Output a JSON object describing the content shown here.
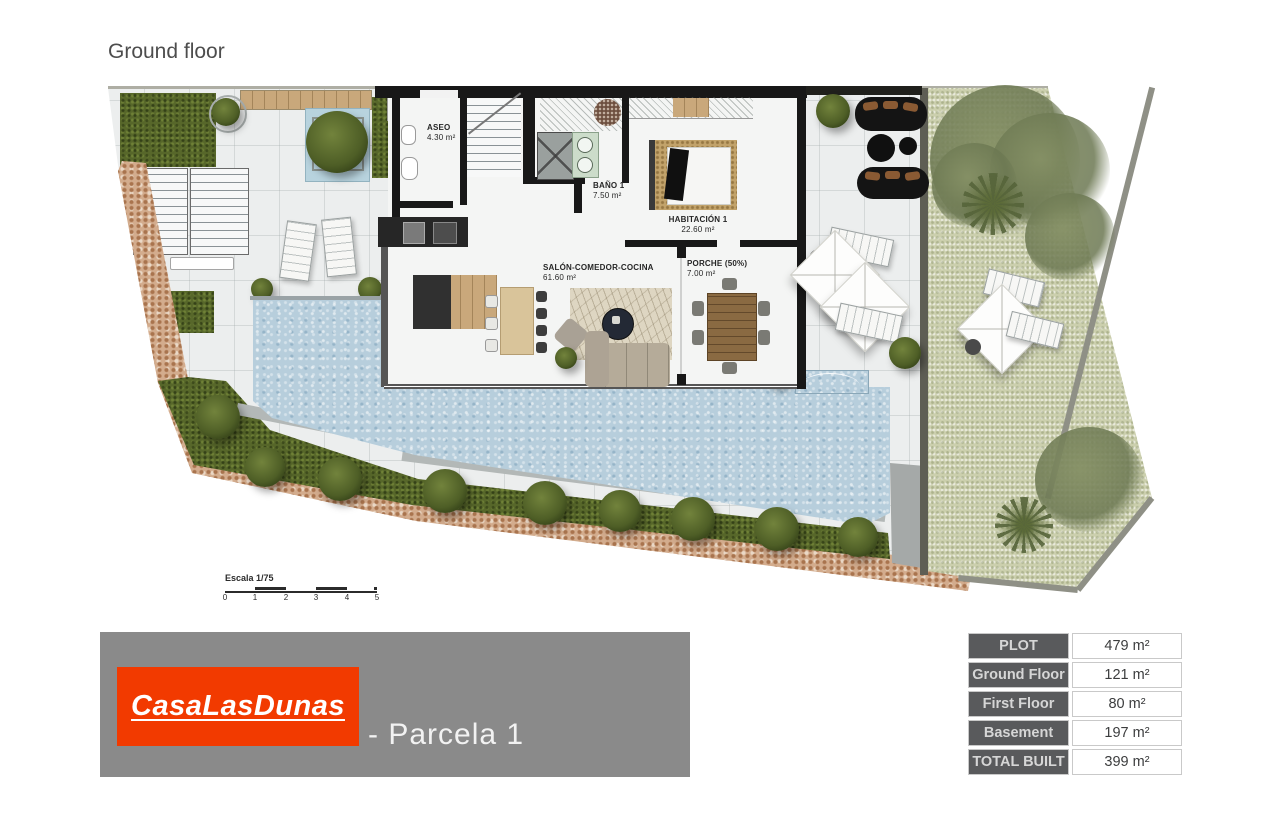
{
  "page": {
    "title": "Ground floor"
  },
  "plan": {
    "rooms": [
      {
        "name": "ASEO",
        "area": "4.30 m²"
      },
      {
        "name": "BAÑO 1",
        "area": "7.50 m²"
      },
      {
        "name": "HABITACIÓN 1",
        "area": "22.60 m²"
      },
      {
        "name": "SALÓN-COMEDOR-COCINA",
        "area": "61.60 m²"
      },
      {
        "name": "PORCHE (50%)",
        "area": "7.00 m²"
      }
    ],
    "scale": {
      "label": "Escala 1/75",
      "ticks": [
        "0",
        "1",
        "2",
        "3",
        "4",
        "5"
      ]
    }
  },
  "branding": {
    "logo_text": "CasaLasDunas",
    "parcel_label": "- Parcela 1"
  },
  "areas_table": {
    "rows": [
      {
        "label": "PLOT",
        "value": "479 m²"
      },
      {
        "label": "Ground Floor",
        "value": "121 m²"
      },
      {
        "label": "First Floor",
        "value": "80 m²"
      },
      {
        "label": "Basement",
        "value": "197 m²"
      },
      {
        "label": "TOTAL BUILT",
        "value": "399 m²"
      }
    ]
  },
  "colors": {
    "logo_red": "#f23a00",
    "panel_gray": "#8a8a8a",
    "table_header_bg": "#595a5c",
    "pool_blue": "#b7cedc",
    "grass_green": "#57672a",
    "gravel_olive": "#cbcfad"
  }
}
